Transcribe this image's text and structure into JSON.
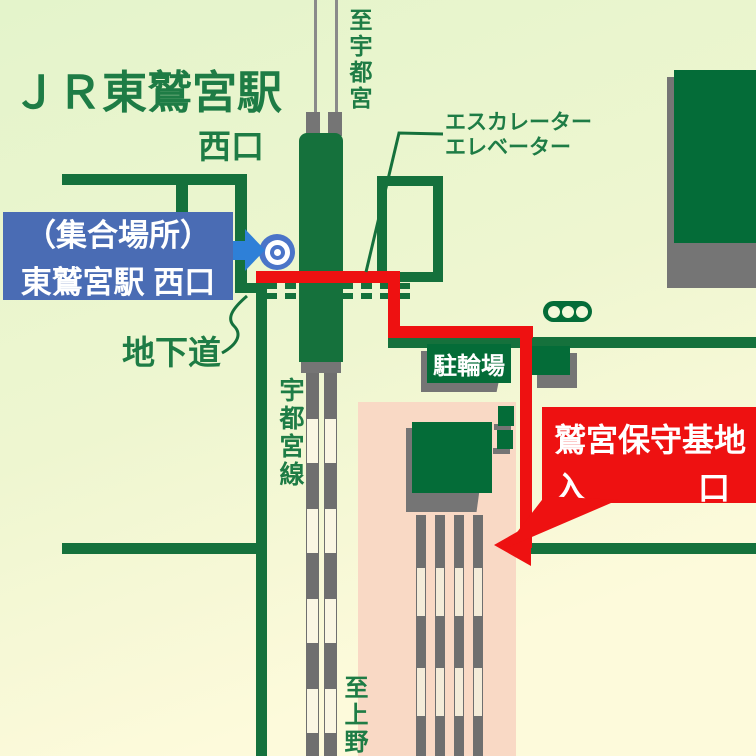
{
  "title": "ＪＲ東鷲宮駅",
  "station": {
    "west_exit": "西口"
  },
  "directions": {
    "to_utsunomiya": "至宇都宮",
    "to_ueno": "至上野"
  },
  "labels": {
    "escalator": "エスカレーター",
    "elevator": "エレベーター",
    "underpass": "地下道",
    "utsunomiya_line": "宇都宮線",
    "bicycle_parking": "駐輪場"
  },
  "meeting_point": {
    "line1": "（集合場所）",
    "line2": "東鷲宮駅 西口"
  },
  "destination": {
    "line1": "鷲宮保守基地",
    "entrance_left": "入",
    "entrance_right": "口"
  },
  "colors": {
    "route_red": "#ee1111",
    "road_green": "#15713c",
    "meeting_box_blue": "#4a6cb4",
    "arrow_blue": "#2e80d8",
    "marker_blue": "#4a74c8",
    "base_area_pink": "#f9d9c5"
  }
}
